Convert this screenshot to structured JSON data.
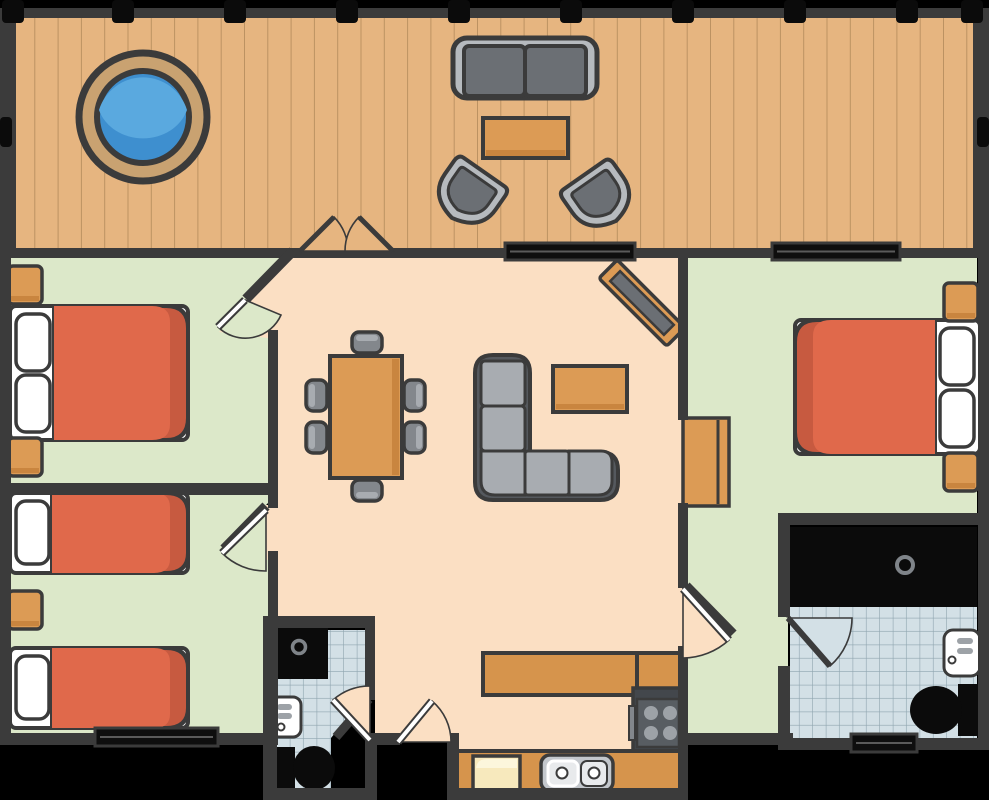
{
  "title": "Apartment floor plan with deck",
  "palette": {
    "outside": "#000000",
    "wall": "#3B3B3B",
    "wood": "#E6B580",
    "plank": "#BC9262",
    "bedroomFloor": "#DCE8C9",
    "livingFloor": "#FBDFC3",
    "tileFloor": "#D3E0E6",
    "tileGrid": "#8FA5AF",
    "furnitureOrange": "#DC9B55",
    "furnitureOrangeDark": "#C9853F",
    "counterOrange": "#D6944C",
    "blanket": "#E0694B",
    "blanketFold": "#C75A40",
    "fixtureWhite": "#FFFFFF",
    "fixtureBlack": "#0B0B0B",
    "grayLight": "#B6BABE",
    "grayMid": "#83878C",
    "grayDark": "#6B6F74",
    "sofaFrame": "#55595E",
    "cushion": "#A8ACB1",
    "stoveBody": "#43474C",
    "stovePanel": "#585D62",
    "burner": "#9DA2A7",
    "water": "#5AA9DF",
    "waterDark": "#3E8FCF",
    "hotTubRim": "#C9A271",
    "cream": "#F7E9BD",
    "creamLight": "#FCF6DC",
    "windowGlass": "#0E0E0E",
    "windowLine": "#5A5A5A",
    "sinkGray": "#C3C7CC",
    "basin": "#E8EAEC"
  },
  "rooms": [
    {
      "name": "deck",
      "floor": "wood planks",
      "furniture": [
        "hot tub",
        "outdoor sofa (2 cushions)",
        "outdoor coffee table",
        "2 rounded chairs"
      ],
      "railing_posts": 10
    },
    {
      "name": "bedroom-1 (top-left)",
      "floor": "green",
      "furniture": [
        "double bed, 2 pillows, headboard on west wall",
        "2 nightstands"
      ]
    },
    {
      "name": "bedroom-2 (bottom-left)",
      "floor": "green",
      "furniture": [
        "single bed (top)",
        "single bed (bottom)",
        "nightstand between beds"
      ],
      "windows": [
        "south wall"
      ]
    },
    {
      "name": "living-dining",
      "floor": "peach",
      "furniture": [
        "dining table with 6 chairs",
        "L-shaped sectional sofa (5 cushions)",
        "coffee table",
        "TV on diagonal stand"
      ],
      "windows": [
        "north wall"
      ],
      "doors": [
        "french double door to deck",
        "door to bedroom-1",
        "door to bedroom-2",
        "door to bedroom-3",
        "entry door (south)"
      ]
    },
    {
      "name": "bedroom-3 (right)",
      "floor": "green",
      "furniture": [
        "double bed, 2 pillows, headboard on east wall",
        "2 nightstands",
        "dresser on west wall"
      ],
      "windows": [
        "north wall"
      ]
    },
    {
      "name": "ensuite-bathroom (right)",
      "floor": "blue tile",
      "fixtures": [
        "bathtub (black)",
        "wall sink",
        "toilet"
      ],
      "windows": [
        "south wall"
      ]
    },
    {
      "name": "bathroom (bottom-left)",
      "floor": "blue tile",
      "fixtures": [
        "shower (black)",
        "wall sink",
        "toilet"
      ]
    },
    {
      "name": "kitchen (bottom)",
      "floor": "peach",
      "fixtures": [
        "upper counter",
        "stove with 4 burners",
        "lower counter with double sink",
        "refrigerator (cream)"
      ]
    }
  ],
  "counts": {
    "doors_with_swing_arcs": 8,
    "windows": 4,
    "beds": 4,
    "toilets": 2,
    "sinks": 3
  }
}
